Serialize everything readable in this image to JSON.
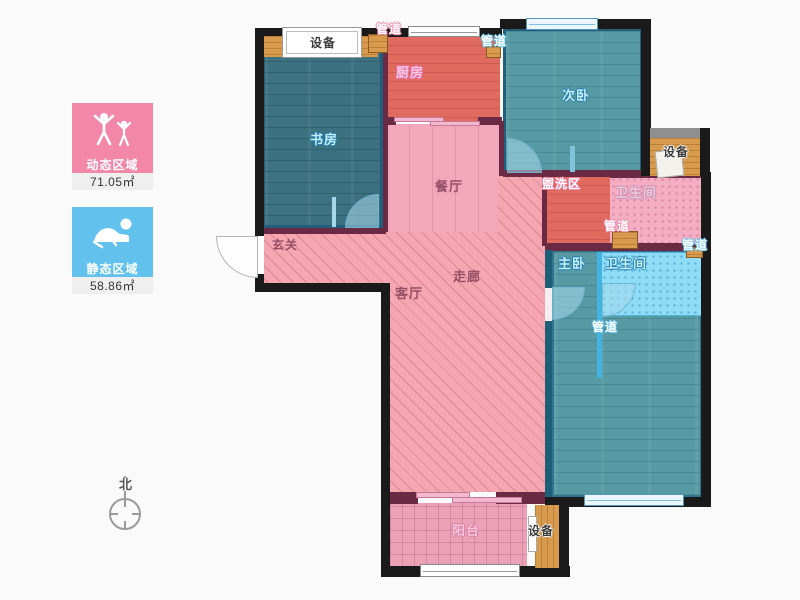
{
  "legend": {
    "dynamic": {
      "label": "动态区域",
      "area": "71.05㎡",
      "color": "#f287a9",
      "icon": "people-cheering-icon"
    },
    "static": {
      "label": "静态区域",
      "area": "58.86㎡",
      "color": "#63c1ee",
      "icon": "person-resting-icon"
    }
  },
  "compass": {
    "north": "北"
  },
  "rooms": {
    "study": "书房",
    "kitchen": "厨房",
    "bedroom2": "次卧",
    "dining": "餐厅",
    "wash": "盥洗区",
    "bath": "卫生间",
    "master": "主卧",
    "entry": "玄关",
    "corridor": "走廊",
    "living": "客厅",
    "balcony": "阳台"
  },
  "fixtures": {
    "equipment": "设备",
    "pipe": "管道"
  },
  "colors": {
    "wall": "#1a1a1a",
    "inner_wall": "#6b2a43",
    "blue_wall": "#1d5f79",
    "teal_room": "#579aa3",
    "dark_teal_room": "#3c7280",
    "red_room": "#e06a5e",
    "pink_zone": "#f5a6b0",
    "pink_bath": "#f4aec3",
    "blue_bath": "#8edcf6",
    "balcony_tile": "#eba2b7",
    "wood_equipment": "#d89b4d"
  }
}
